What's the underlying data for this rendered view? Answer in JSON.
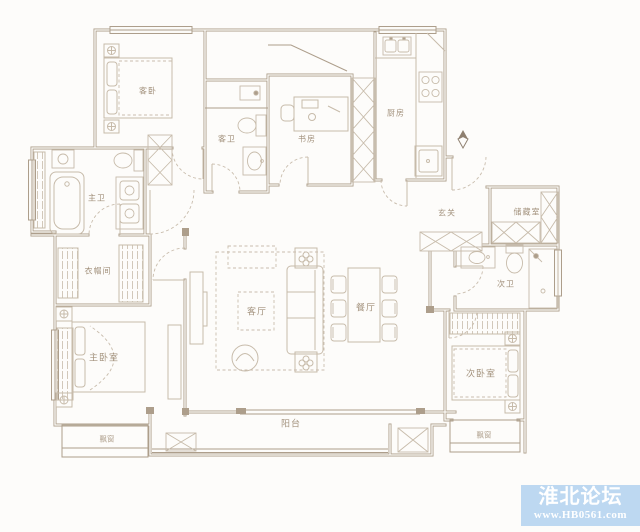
{
  "plan": {
    "colors": {
      "wall": "#ad9e8b",
      "wall_core": "#fbfaf7",
      "furniture": "#c7bbaa",
      "dash": "#c9bdad",
      "label": "#a3927d",
      "background": "#fdfcfa"
    },
    "rooms": {
      "guest_bedroom": "客卧",
      "guest_bath": "客卫",
      "study": "书房",
      "kitchen": "厨房",
      "master_bath": "主卫",
      "cloakroom": "衣帽间",
      "living_room": "客厅",
      "dining_room": "餐厅",
      "foyer": "玄关",
      "storage": "储藏室",
      "second_bath": "次卫",
      "master_bedroom": "主卧室",
      "second_bedroom": "次卧室",
      "balcony": "阳台",
      "bay_window_left": "飘窗",
      "bay_window_right": "飘窗"
    }
  },
  "watermark": {
    "site_name": "淮北论坛",
    "site_url": "www.HB0561.com",
    "bg_color": "#bdd8f1",
    "text_color": "#ffffff"
  }
}
